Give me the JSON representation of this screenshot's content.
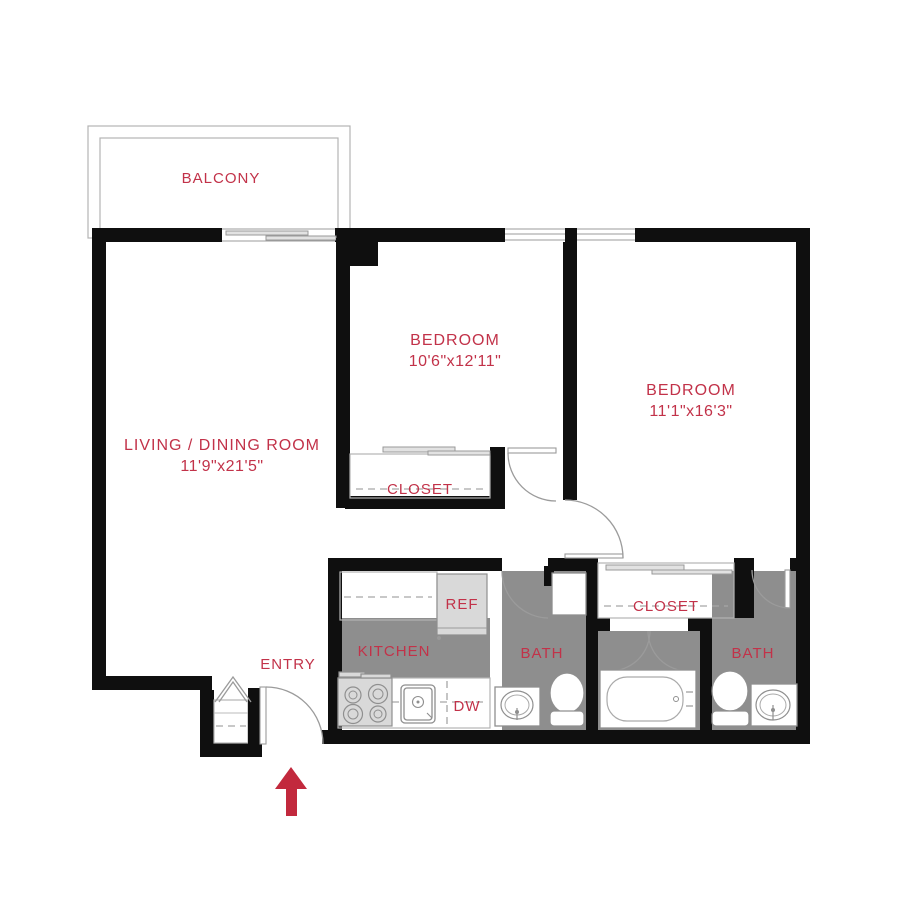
{
  "plan_type": "apartment-floor-plan",
  "colors": {
    "accent_red": "#c23249",
    "arrow_red": "#c2293d",
    "wall_black": "#0f0f0f",
    "floor_gray": "#8e8e8e",
    "appliance_gray": "#d9d9d9"
  },
  "rooms": {
    "balcony": {
      "label": "BALCONY"
    },
    "bedroom1": {
      "label": "BEDROOM",
      "dimensions": "10'6\"x12'11\""
    },
    "bedroom2": {
      "label": "BEDROOM",
      "dimensions": "11'1\"x16'3\""
    },
    "living_dining": {
      "label": "LIVING / DINING ROOM",
      "dimensions": "11'9\"x21'5\""
    },
    "kitchen": {
      "label": "KITCHEN"
    },
    "bath1": {
      "label": "BATH"
    },
    "bath2": {
      "label": "BATH"
    },
    "closet1": {
      "label": "CLOSET"
    },
    "closet2": {
      "label": "CLOSET"
    },
    "entry": {
      "label": "ENTRY"
    }
  },
  "appliances": {
    "refrigerator": "REF",
    "dishwasher": "DW"
  }
}
